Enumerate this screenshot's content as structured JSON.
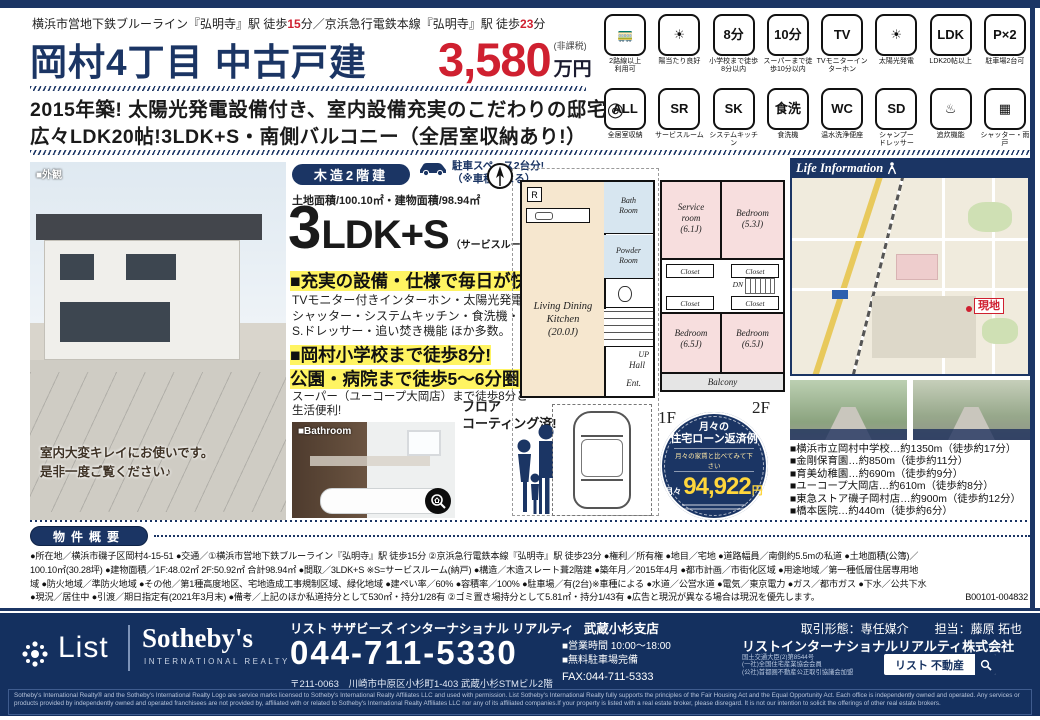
{
  "colors": {
    "navy": "#1b3564",
    "red": "#cf2030",
    "highlight": "#fff462"
  },
  "header": {
    "access_line1": "横浜市営地下鉄ブルーライン『弘明寺』駅 徒歩",
    "access_min1": "15",
    "access_mid": "分／京浜急行電鉄本線『弘明寺』駅 徒歩",
    "access_min2": "23",
    "access_end": "分",
    "title": "岡村4丁目 中古戸建",
    "price_number": "3,580",
    "price_tax_note": "(非課税)",
    "price_unit": "万円"
  },
  "feature_icons": [
    {
      "glyph": "🚃",
      "label": "2路線以上\n利用可"
    },
    {
      "glyph": "☀",
      "label": "陽当たり良好"
    },
    {
      "glyph": "8分",
      "label": "小学校まで徒歩\n8分以内"
    },
    {
      "glyph": "10分",
      "label": "スーパーまで徒歩10分以内"
    },
    {
      "glyph": "TV",
      "label": "TVモニターインターホン"
    },
    {
      "glyph": "☀",
      "label": "太陽光発電"
    },
    {
      "glyph": "LDK",
      "label": "LDK20帖以上"
    },
    {
      "glyph": "P×2",
      "label": "駐車場2台可"
    },
    {
      "glyph": "ALL",
      "label": "全居室収納"
    },
    {
      "glyph": "SR",
      "label": "サービスルーム"
    },
    {
      "glyph": "SK",
      "label": "システムキッチン"
    },
    {
      "glyph": "食洗",
      "label": "食洗機"
    },
    {
      "glyph": "WC",
      "label": "温水洗浄便座"
    },
    {
      "glyph": "SD",
      "label": "シャンプー\nドレッサー"
    },
    {
      "glyph": "♨",
      "label": "追炊機能"
    },
    {
      "glyph": "▦",
      "label": "シャッター・雨戸"
    }
  ],
  "catch": {
    "line1": "2015年築! 太陽光発電設備付き、室内設備充実のこだわりの邸宅◎",
    "line2": "広々LDK20帖!3LDK+S・南側バルコニー（全居室収納あり!）"
  },
  "exterior": {
    "tag": "■外観",
    "caption1": "室内大変キレイにお使いです。",
    "caption2": "是非一度ご覧ください♪"
  },
  "spec": {
    "structure": "木造2階建",
    "parking1": "駐車スペース2台分!",
    "parking2": "（※車種による）",
    "area": "土地面積/100.10㎡・建物面積/98.94㎡",
    "layout_num": "3",
    "layout_type": "LDK+S",
    "layout_note": "（サービスルーム6.1帖）",
    "pt1_title": "■充実の設備・仕様で毎日が快適!",
    "pt1_l1": "TVモニター付きインターホン・太陽光発電設備・",
    "pt1_l2": "シャッター・システムキッチン・食洗機・温水洗浄便器",
    "pt1_l3": "S.ドレッサー・追い焚き機能 ほか多数。",
    "pt2_title": "■岡村小学校まで徒歩8分!",
    "pt2_sub": "公園・病院まで徒歩5〜6分圏内!",
    "pt2_l1": "スーパー（ユーコープ大岡店）まで徒歩8分と",
    "pt2_l2": "生活便利!"
  },
  "bath": {
    "tag": "■Bathroom",
    "coat1": "フロア",
    "coat2": "コーティング済!"
  },
  "plan": {
    "f1_label": "1F",
    "f2_label": "2F",
    "r": "R",
    "ldk": "Living Dining\nKitchen\n(20.0J)",
    "bath": "Bath\nRoom",
    "powder": "Powder\nRoom",
    "up": "UP",
    "hall": "Hall",
    "ent": "Ent.",
    "service": "Service\nroom\n(6.1J)",
    "bed1": "Bedroom\n(5.3J)",
    "bed2": "Bedroom\n(6.5J)",
    "bed3": "Bedroom\n(6.5J)",
    "closet": "Closet",
    "dn": "DN",
    "balcony": "Balcony"
  },
  "loan": {
    "t1": "月々の",
    "t2": "住宅ローン返済例",
    "t3": "月々の家賃と比べてみて下さい",
    "monthly": "月々",
    "amount": "94,922",
    "unit": "円"
  },
  "life": {
    "header": "Life Information",
    "site_label": "現地",
    "items": [
      "■横浜市立岡村中学校…約1350m（徒歩約17分）",
      "■金剛保育園…約850m（徒歩約11分）",
      "■育美幼稚園…約690m（徒歩約9分）",
      "■ユーコープ大岡店…約610m（徒歩約8分）",
      "■東急ストア磯子岡村店…約900m（徒歩約12分）",
      "■橋本医院…約440m（徒歩約6分）"
    ]
  },
  "overview": {
    "badge": "物件概要",
    "l1": "●所在地／横浜市磯子区岡村4-15-51 ●交通／①横浜市営地下鉄ブルーライン『弘明寺』駅 徒歩15分 ②京浜急行電鉄本線『弘明寺』駅 徒歩23分 ●権利／所有権 ●地目／宅地 ●道路幅員／南側約5.5mの私道 ●土地面積(公簿)／",
    "l2": "100.10㎡(30.28坪) ●建物面積／1F:48.02㎡ 2F:50.92㎡ 合計98.94㎡ ●間取／3LDK+S ※S=サービスルーム(納戸) ●構造／木造スレート葺2階建 ●築年月／2015年4月 ●都市計画／市街化区域 ●用途地域／第一種低層住居専用地",
    "l3": "域 ●防火地域／準防火地域 ●その他／第1種高度地区、宅地造成工事規制区域、緑化地域 ●建ぺい率／60% ●容積率／100% ●駐車場／有(2台)※車種による ●水道／公営水道 ●電気／東京電力 ●ガス／都市ガス ●下水／公共下水",
    "l4": "●現況／居住中 ●引渡／期日指定有(2021年3月末) ●備考／上記のほか私道持分として530㎡・持分1/28有 ②ゴミ置き場持分として5.81㎡・持分1/43有 ●広告と現況が異なる場合は現況を優先します。",
    "code": "B00101-004832"
  },
  "footer": {
    "logo_list": "List",
    "logo_sothebys": "Sotheby's",
    "logo_sub": "INTERNATIONAL REALTY",
    "office": "リスト サザビーズ インターナショナル リアルティ",
    "branch": "武蔵小杉支店",
    "deal_type": "取引形態：専任媒介",
    "agent": "担当：藤原 拓也",
    "phone": "044-711-5330",
    "address": "〒211-0063　川崎市中原区小杉町1-403 武蔵小杉STMビル2階",
    "hours": "■営業時間 10:00〜18:00",
    "parking": "■無料駐車場完備",
    "fax": "FAX:044-711-5333",
    "company": "リストインターナショナルリアルティ株式会社",
    "licenses": [
      "国土交通大臣(2)第8544号",
      "(一社)全国住宅産業協会会員",
      "(公社)首都圏不動産公正取引協議会加盟"
    ],
    "search_label": "リスト 不動産",
    "disclaimer": "Sotheby's International Realty® and the Sotheby's International Realty Logo are service marks licensed to Sotheby's International Realty Affiliates LLC and used with permission. List Sotheby's International Realty fully supports the principles of the Fair Housing Act and the Equal Opportunity Act. Each office is independently owned and operated. Any services or products provided by independently owned and operated franchisees are not provided by, affiliated with or related to Sotheby's International Realty Affiliates LLC nor any of its affiliated companies.If your property is listed with a real estate broker, please disregard. It is not our intention to solicit the offerings of other real estate brokers."
  }
}
